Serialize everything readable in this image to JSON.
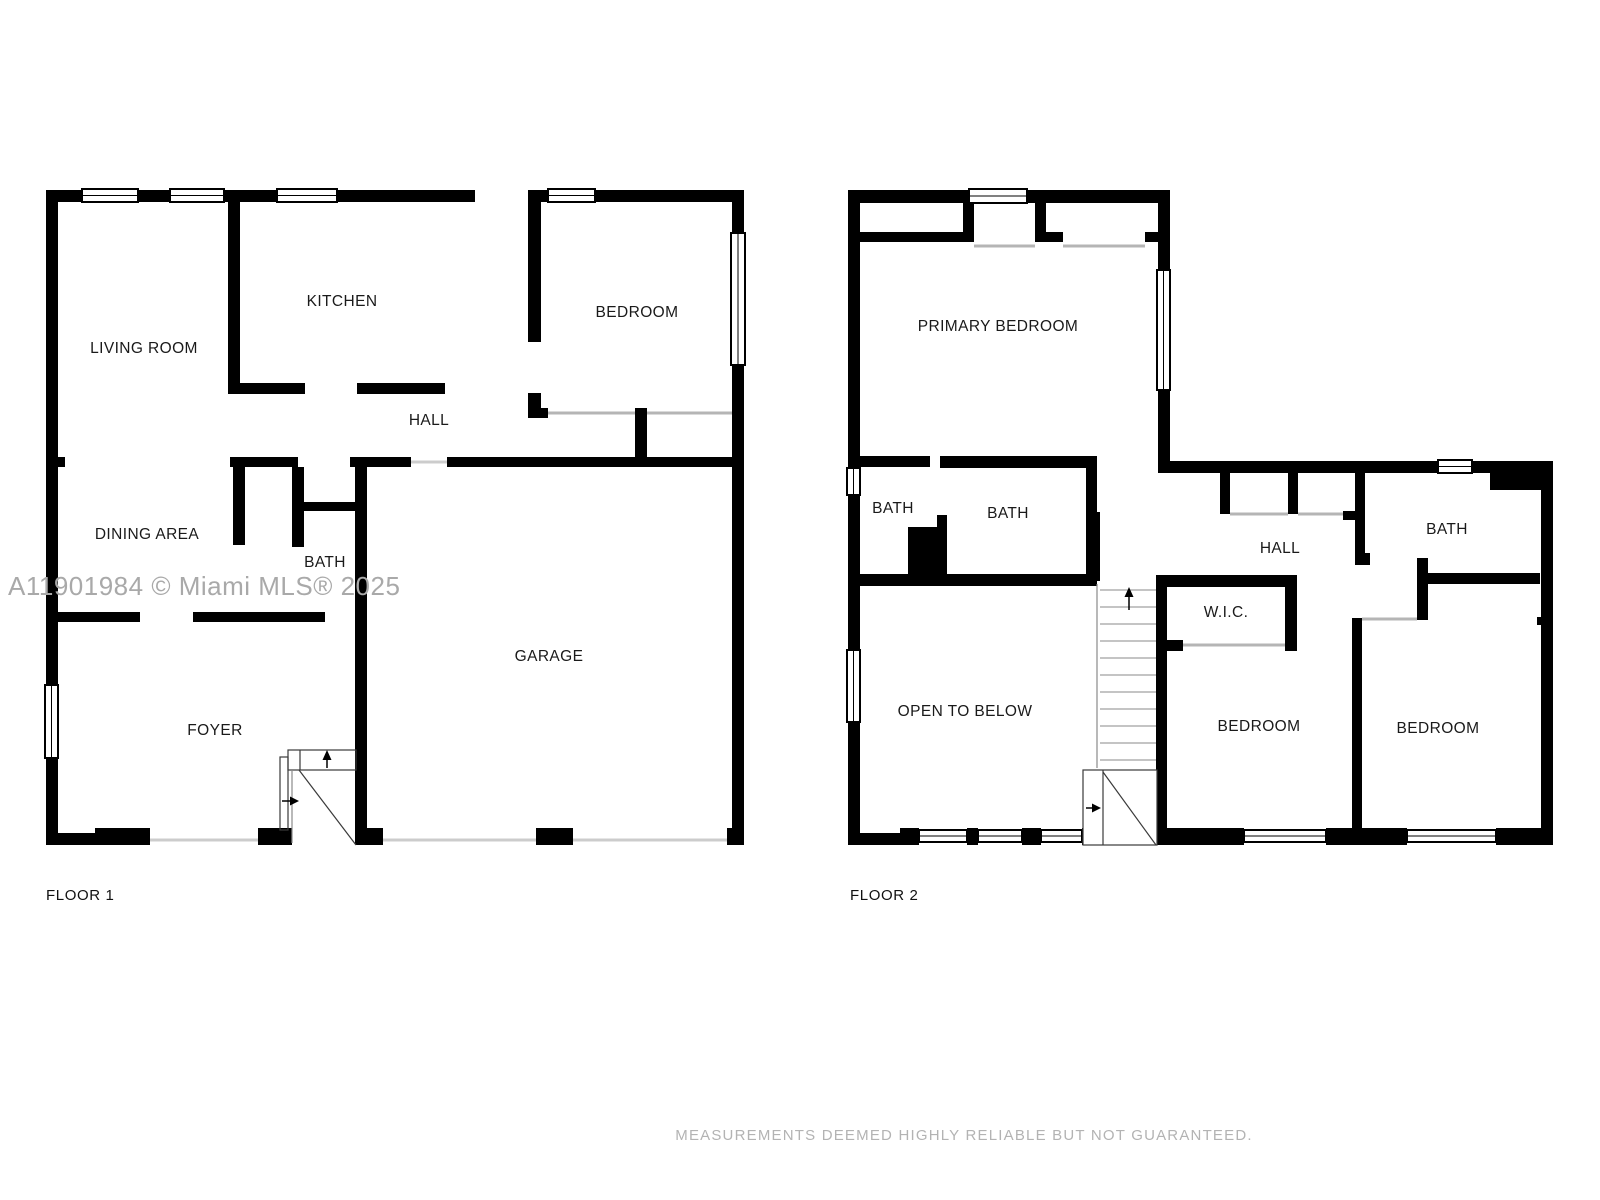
{
  "colors": {
    "background": "#ffffff",
    "walls": "#000000",
    "label_text": "#1a1a1a",
    "watermark_text": "#a9a9a9",
    "disclaimer_text": "#b3b3b3",
    "door_opening_line": "#cccccc",
    "sill_line": "#b5b5b5",
    "stair_tread_line": "#8a8a8a"
  },
  "watermark": {
    "text": "A11901984 © Miami MLS® 2025"
  },
  "disclaimer": {
    "text": "MEASUREMENTS DEEMED HIGHLY RELIABLE BUT NOT GUARANTEED."
  },
  "floors": [
    {
      "name": "FLOOR 1",
      "rooms": [
        {
          "label": "LIVING ROOM",
          "x": 144,
          "y": 349
        },
        {
          "label": "KITCHEN",
          "x": 342,
          "y": 302
        },
        {
          "label": "BEDROOM",
          "x": 637,
          "y": 313
        },
        {
          "label": "HALL",
          "x": 429,
          "y": 421
        },
        {
          "label": "DINING AREA",
          "x": 147,
          "y": 535
        },
        {
          "label": "BATH",
          "x": 325,
          "y": 563
        },
        {
          "label": "GARAGE",
          "x": 549,
          "y": 657
        },
        {
          "label": "FOYER",
          "x": 215,
          "y": 731
        }
      ]
    },
    {
      "name": "FLOOR 2",
      "rooms": [
        {
          "label": "PRIMARY BEDROOM",
          "x": 998,
          "y": 327
        },
        {
          "label": "BATH",
          "x": 893,
          "y": 509
        },
        {
          "label": "BATH",
          "x": 1008,
          "y": 514
        },
        {
          "label": "HALL",
          "x": 1280,
          "y": 549
        },
        {
          "label": "BATH",
          "x": 1447,
          "y": 530
        },
        {
          "label": "W.I.C.",
          "x": 1226,
          "y": 613
        },
        {
          "label": "OPEN TO BELOW",
          "x": 965,
          "y": 712
        },
        {
          "label": "BEDROOM",
          "x": 1259,
          "y": 727
        },
        {
          "label": "BEDROOM",
          "x": 1438,
          "y": 729
        }
      ]
    }
  ]
}
